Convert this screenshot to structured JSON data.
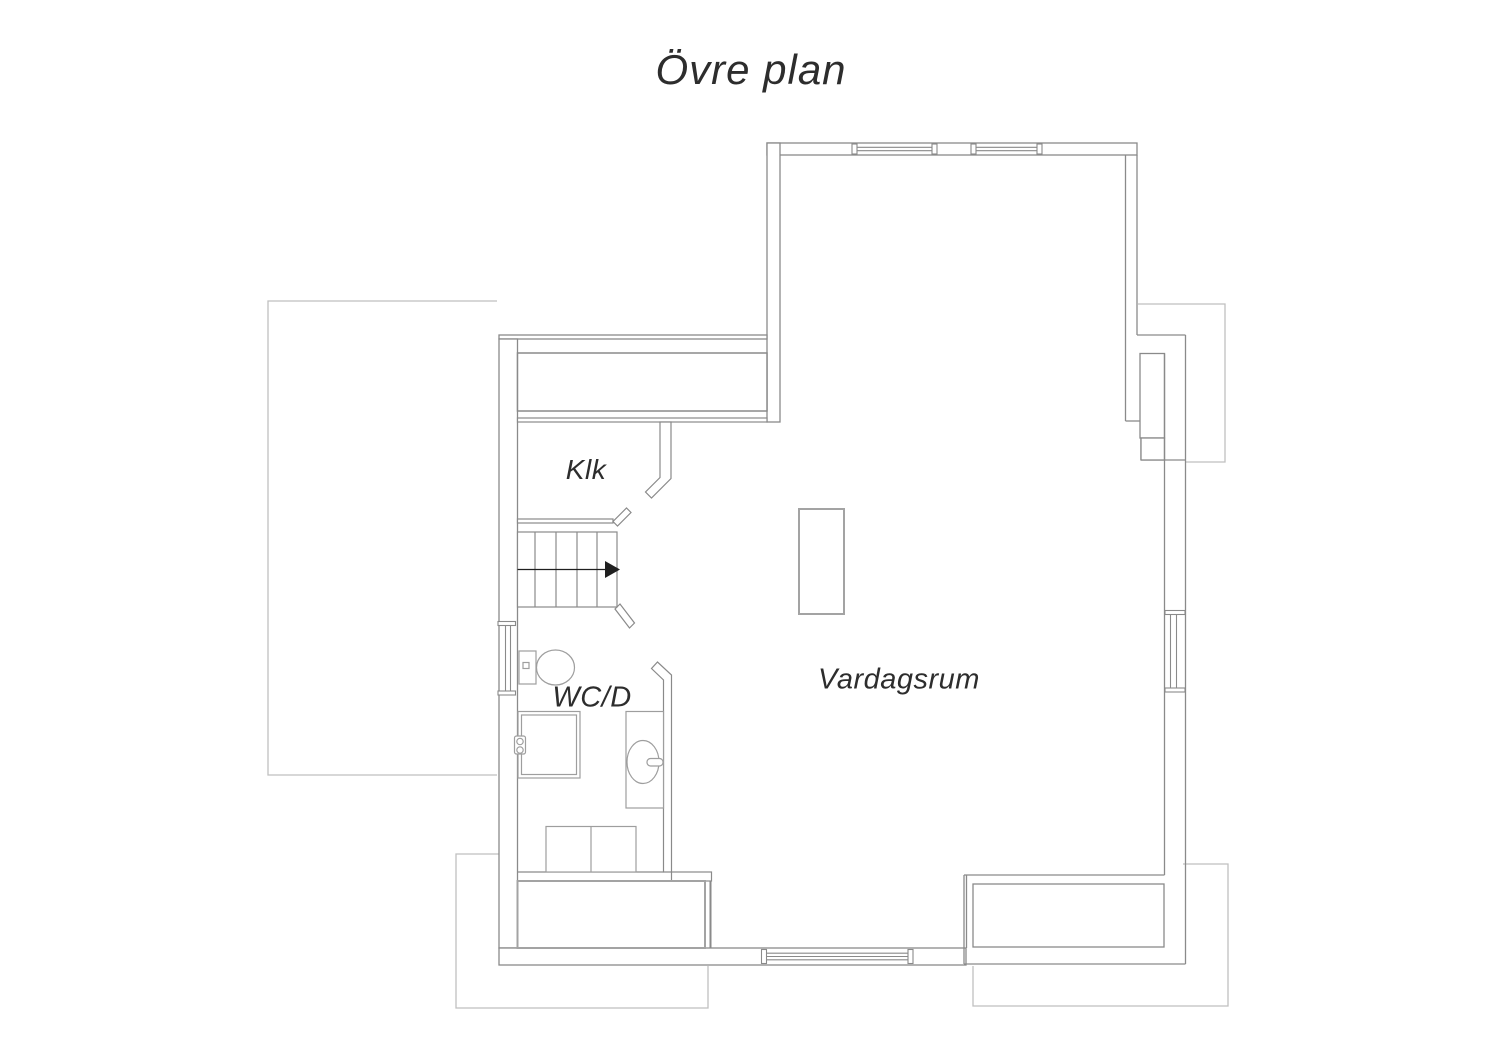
{
  "labels": {
    "title": {
      "text": "Övre plan",
      "x": 751,
      "y": 70,
      "fs": 42
    },
    "klk": {
      "text": "Klk",
      "x": 586,
      "y": 470,
      "fs": 28
    },
    "wcd": {
      "text": "WC/D",
      "x": 592,
      "y": 698,
      "fs": 29
    },
    "vardagsrum": {
      "text": "Vardagsrum",
      "x": 899,
      "y": 680,
      "fs": 29
    }
  },
  "colors": {
    "wall": "#8a8a8a",
    "roof": "#bfbfbf",
    "fixture": "#9e9e9e",
    "storage": "#a3a3a3",
    "arrow": "#1f1f1f",
    "text": "#2d2d2d",
    "white": "#ffffff"
  },
  "canvas": {
    "w": 1500,
    "h": 1060
  },
  "plan": {
    "groups": [
      {
        "name": "roof-outlines",
        "stroke": "roof",
        "sw": 1.3,
        "elements": [
          {
            "t": "path",
            "d": "M497,301 H268 V775 H497",
            "n": "roof-left"
          },
          {
            "t": "path",
            "d": "M499,854 H456 V1008 H708 V966",
            "n": "roof-bottom-left"
          },
          {
            "t": "path",
            "d": "M1183,864 H1228 V1006 H973 V966",
            "n": "roof-bottom-right"
          },
          {
            "t": "path",
            "d": "M1138,304 H1225 V462 H1186",
            "n": "roof-right"
          }
        ]
      },
      {
        "name": "exterior-walls",
        "stroke": "wall",
        "sw": 1.3,
        "elements": [
          {
            "t": "rect",
            "x": 767,
            "y": 143,
            "w": 370,
            "h": 12,
            "f": "white",
            "n": "wall-top"
          },
          {
            "t": "rect",
            "x": 767,
            "y": 143,
            "w": 13,
            "h": 279,
            "f": "white",
            "n": "wall-upper-west"
          },
          {
            "t": "rect",
            "x": 499,
            "y": 335,
            "w": 268,
            "h": 4,
            "f": "white",
            "n": "wall-west-wing-top"
          },
          {
            "t": "rect",
            "x": 499,
            "y": 339,
            "w": 18.5,
            "h": 609,
            "f": "white",
            "n": "wall-west"
          },
          {
            "t": "rect",
            "x": 499,
            "y": 948,
            "w": 467,
            "h": 17,
            "f": "white",
            "n": "wall-bottom"
          },
          {
            "t": "line",
            "x1": 1125.5,
            "y1": 155,
            "x2": 1125.5,
            "y2": 421
          },
          {
            "t": "line",
            "x1": 1137,
            "y1": 155,
            "x2": 1137,
            "y2": 335
          },
          {
            "t": "line",
            "x1": 1137,
            "y1": 335,
            "x2": 1185.5,
            "y2": 335
          },
          {
            "t": "line",
            "x1": 1125.5,
            "y1": 421,
            "x2": 1141,
            "y2": 421
          },
          {
            "t": "line",
            "x1": 1141,
            "y1": 421,
            "x2": 1141,
            "y2": 460
          },
          {
            "t": "line",
            "x1": 1141,
            "y1": 460,
            "x2": 1185.5,
            "y2": 460
          },
          {
            "t": "rect",
            "x": 1140,
            "y": 353.5,
            "w": 24.5,
            "h": 84.5,
            "f": "white",
            "n": "chimney-shaft"
          },
          {
            "t": "rect",
            "x": 1141,
            "y": 438,
            "w": 23.5,
            "h": 22,
            "f": "white"
          },
          {
            "t": "line",
            "x1": 1164.5,
            "y1": 353.5,
            "x2": 1164.5,
            "y2": 875,
            "n": "wall-east-inner"
          },
          {
            "t": "line",
            "x1": 1185.5,
            "y1": 335,
            "x2": 1185.5,
            "y2": 964,
            "n": "wall-east-outer"
          }
        ]
      },
      {
        "name": "balcony",
        "stroke": "wall",
        "sw": 1.3,
        "elements": [
          {
            "t": "line",
            "x1": 964,
            "y1": 875,
            "x2": 1164.5,
            "y2": 875
          },
          {
            "t": "line",
            "x1": 964,
            "y1": 875,
            "x2": 964,
            "y2": 964
          },
          {
            "t": "line",
            "x1": 966.5,
            "y1": 875,
            "x2": 966.5,
            "y2": 948
          },
          {
            "t": "line",
            "x1": 964,
            "y1": 964,
            "x2": 1185.5,
            "y2": 964
          },
          {
            "t": "rect",
            "x": 973,
            "y": 884,
            "w": 191,
            "h": 63,
            "n": "balcony-floor"
          }
        ]
      },
      {
        "name": "interior-walls",
        "stroke": "wall",
        "sw": 1.2,
        "elements": [
          {
            "t": "rect",
            "x": 517.5,
            "y": 353,
            "w": 249.5,
            "h": 58,
            "f": "white",
            "sw": 1.5,
            "n": "wardrobe-unit"
          },
          {
            "t": "rect",
            "x": 517.5,
            "y": 418,
            "w": 249.5,
            "h": 4,
            "f": "white",
            "n": "closet-front"
          },
          {
            "t": "path",
            "d": "M660,422 L671,422 L671,478.5 L651.5,498 L645.5,492 L660,477.5 Z",
            "f": "white",
            "n": "klk-east-wall"
          },
          {
            "t": "rect",
            "x": 517.5,
            "y": 519,
            "w": 95.5,
            "h": 4,
            "f": "white",
            "n": "klk-south-wall"
          },
          {
            "t": "polygon",
            "pts": "613,521.5 617.5,526 631,512.5 626.5,508",
            "f": "white",
            "n": "door-jamb-klk"
          },
          {
            "t": "polygon",
            "pts": "615,609 620,604 634.5,623 629.5,628",
            "f": "white",
            "n": "door-jamb-stairs"
          },
          {
            "t": "path",
            "d": "M663.5,872 L663.5,680 L651.5,668.5 L657.5,662 L671.5,675 L671.5,872 Z",
            "f": "white",
            "n": "wcd-east-wall"
          },
          {
            "t": "line",
            "x1": 517.5,
            "y1": 872,
            "x2": 663.5,
            "y2": 872
          },
          {
            "t": "rect",
            "x": 671.5,
            "y": 872,
            "w": 40,
            "h": 9,
            "f": "white"
          },
          {
            "t": "line",
            "x1": 710.5,
            "y1": 881,
            "x2": 710.5,
            "y2": 948,
            "sw": 2
          },
          {
            "t": "rect",
            "x": 517.5,
            "y": 881,
            "w": 187.5,
            "h": 67,
            "s": "storage",
            "sw": 2,
            "n": "storage-closet"
          }
        ]
      },
      {
        "name": "stairs",
        "stroke": "wall",
        "sw": 1.2,
        "elements": [
          {
            "t": "rect",
            "x": 517.5,
            "y": 532,
            "w": 99.5,
            "h": 75,
            "f": "white",
            "n": "stairs-outline"
          },
          {
            "t": "line",
            "x1": 535,
            "y1": 532,
            "x2": 535,
            "y2": 607
          },
          {
            "t": "line",
            "x1": 556,
            "y1": 532,
            "x2": 556,
            "y2": 607
          },
          {
            "t": "line",
            "x1": 577,
            "y1": 532,
            "x2": 577,
            "y2": 607
          },
          {
            "t": "line",
            "x1": 597,
            "y1": 532,
            "x2": 597,
            "y2": 607
          },
          {
            "t": "line",
            "x1": 517.5,
            "y1": 569.5,
            "x2": 607,
            "y2": 569.5,
            "s": "arrow",
            "sw": 1.2,
            "n": "stairs-walkline"
          },
          {
            "t": "polygon",
            "pts": "605,561 620,569.5 605,578",
            "f": "arrow",
            "s": "none",
            "n": "stairs-direction-arrow"
          }
        ]
      },
      {
        "name": "windows",
        "stroke": "wall",
        "sw": 1.1,
        "elements": [
          {
            "t": "rect",
            "x": 852,
            "y": 144,
            "w": 5,
            "h": 10,
            "f": "white",
            "n": "window-top-1-cap"
          },
          {
            "t": "rect",
            "x": 932,
            "y": 144,
            "w": 5,
            "h": 10,
            "f": "white"
          },
          {
            "t": "line",
            "x1": 857,
            "y1": 147.3,
            "x2": 932,
            "y2": 147.3,
            "n": "window-top-1"
          },
          {
            "t": "line",
            "x1": 857,
            "y1": 150.7,
            "x2": 932,
            "y2": 150.7
          },
          {
            "t": "rect",
            "x": 971,
            "y": 144,
            "w": 5,
            "h": 10,
            "f": "white",
            "n": "window-top-2-cap"
          },
          {
            "t": "rect",
            "x": 1037,
            "y": 144,
            "w": 5,
            "h": 10,
            "f": "white"
          },
          {
            "t": "line",
            "x1": 976,
            "y1": 147.3,
            "x2": 1037,
            "y2": 147.3,
            "n": "window-top-2"
          },
          {
            "t": "line",
            "x1": 976,
            "y1": 150.7,
            "x2": 1037,
            "y2": 150.7
          },
          {
            "t": "rect",
            "x": 498,
            "y": 621.5,
            "w": 17.5,
            "h": 4,
            "f": "white",
            "n": "window-west-cap"
          },
          {
            "t": "rect",
            "x": 498,
            "y": 691,
            "w": 17.5,
            "h": 4,
            "f": "white"
          },
          {
            "t": "line",
            "x1": 505.5,
            "y1": 625.5,
            "x2": 505.5,
            "y2": 691,
            "n": "window-west"
          },
          {
            "t": "line",
            "x1": 510.5,
            "y1": 625.5,
            "x2": 510.5,
            "y2": 691
          },
          {
            "t": "rect",
            "x": 761.5,
            "y": 949.5,
            "w": 5,
            "h": 14,
            "f": "white",
            "n": "window-bottom-cap"
          },
          {
            "t": "rect",
            "x": 908,
            "y": 949.5,
            "w": 5,
            "h": 14,
            "f": "white"
          },
          {
            "t": "line",
            "x1": 766.5,
            "y1": 953.2,
            "x2": 908,
            "y2": 953.2,
            "n": "window-bottom"
          },
          {
            "t": "line",
            "x1": 766.5,
            "y1": 956.5,
            "x2": 908,
            "y2": 956.5
          },
          {
            "t": "line",
            "x1": 766.5,
            "y1": 959.8,
            "x2": 908,
            "y2": 959.8
          },
          {
            "t": "rect",
            "x": 1165,
            "y": 610.5,
            "w": 20,
            "h": 4,
            "f": "white",
            "n": "window-east-cap"
          },
          {
            "t": "rect",
            "x": 1165,
            "y": 688,
            "w": 20,
            "h": 4,
            "f": "white"
          },
          {
            "t": "line",
            "x1": 1170.5,
            "y1": 614.5,
            "x2": 1170.5,
            "y2": 688,
            "n": "window-east"
          },
          {
            "t": "line",
            "x1": 1176.5,
            "y1": 614.5,
            "x2": 1176.5,
            "y2": 688
          }
        ]
      },
      {
        "name": "fixtures",
        "stroke": "fixture",
        "sw": 1.2,
        "elements": [
          {
            "t": "rect",
            "x": 519,
            "y": 651,
            "w": 17,
            "h": 33,
            "f": "white",
            "n": "toilet-tank"
          },
          {
            "t": "ellipse",
            "cx": 555.5,
            "cy": 667.5,
            "rx": 19,
            "ry": 17.5,
            "f": "white",
            "n": "toilet-bowl"
          },
          {
            "t": "rect",
            "x": 523,
            "y": 662.5,
            "w": 6,
            "h": 6,
            "f": "white",
            "n": "toilet-button"
          },
          {
            "t": "rect",
            "x": 518,
            "y": 711.5,
            "w": 62,
            "h": 66.5,
            "f": "white",
            "n": "shower"
          },
          {
            "t": "rect",
            "x": 521.5,
            "y": 715,
            "w": 55,
            "h": 59.5,
            "f": "white"
          },
          {
            "t": "rect",
            "x": 514.5,
            "y": 736,
            "w": 11,
            "h": 18,
            "rx": 2,
            "f": "white",
            "n": "shower-mixer"
          },
          {
            "t": "circle",
            "cx": 520,
            "cy": 741.5,
            "r": 3.2,
            "f": "white"
          },
          {
            "t": "circle",
            "cx": 520,
            "cy": 750,
            "r": 3.2,
            "f": "white"
          },
          {
            "t": "rect",
            "x": 626,
            "y": 711.5,
            "w": 37.5,
            "h": 96.5,
            "f": "white",
            "n": "sink-counter"
          },
          {
            "t": "ellipse",
            "cx": 643,
            "cy": 762,
            "rx": 16,
            "ry": 21.5,
            "f": "white",
            "n": "sink-bowl"
          },
          {
            "t": "rect",
            "x": 647,
            "y": 758.5,
            "w": 16,
            "h": 7.5,
            "rx": 3.5,
            "f": "white",
            "n": "sink-faucet"
          },
          {
            "t": "rect",
            "x": 546,
            "y": 826.5,
            "w": 90,
            "h": 45.5,
            "f": "white",
            "n": "washer-dryer"
          },
          {
            "t": "line",
            "x1": 591,
            "y1": 826.5,
            "x2": 591,
            "y2": 872
          },
          {
            "t": "rect",
            "x": 799,
            "y": 509,
            "w": 45,
            "h": 105,
            "sw": 2,
            "s": "storage",
            "f": "white",
            "n": "island-furniture"
          }
        ]
      }
    ]
  }
}
